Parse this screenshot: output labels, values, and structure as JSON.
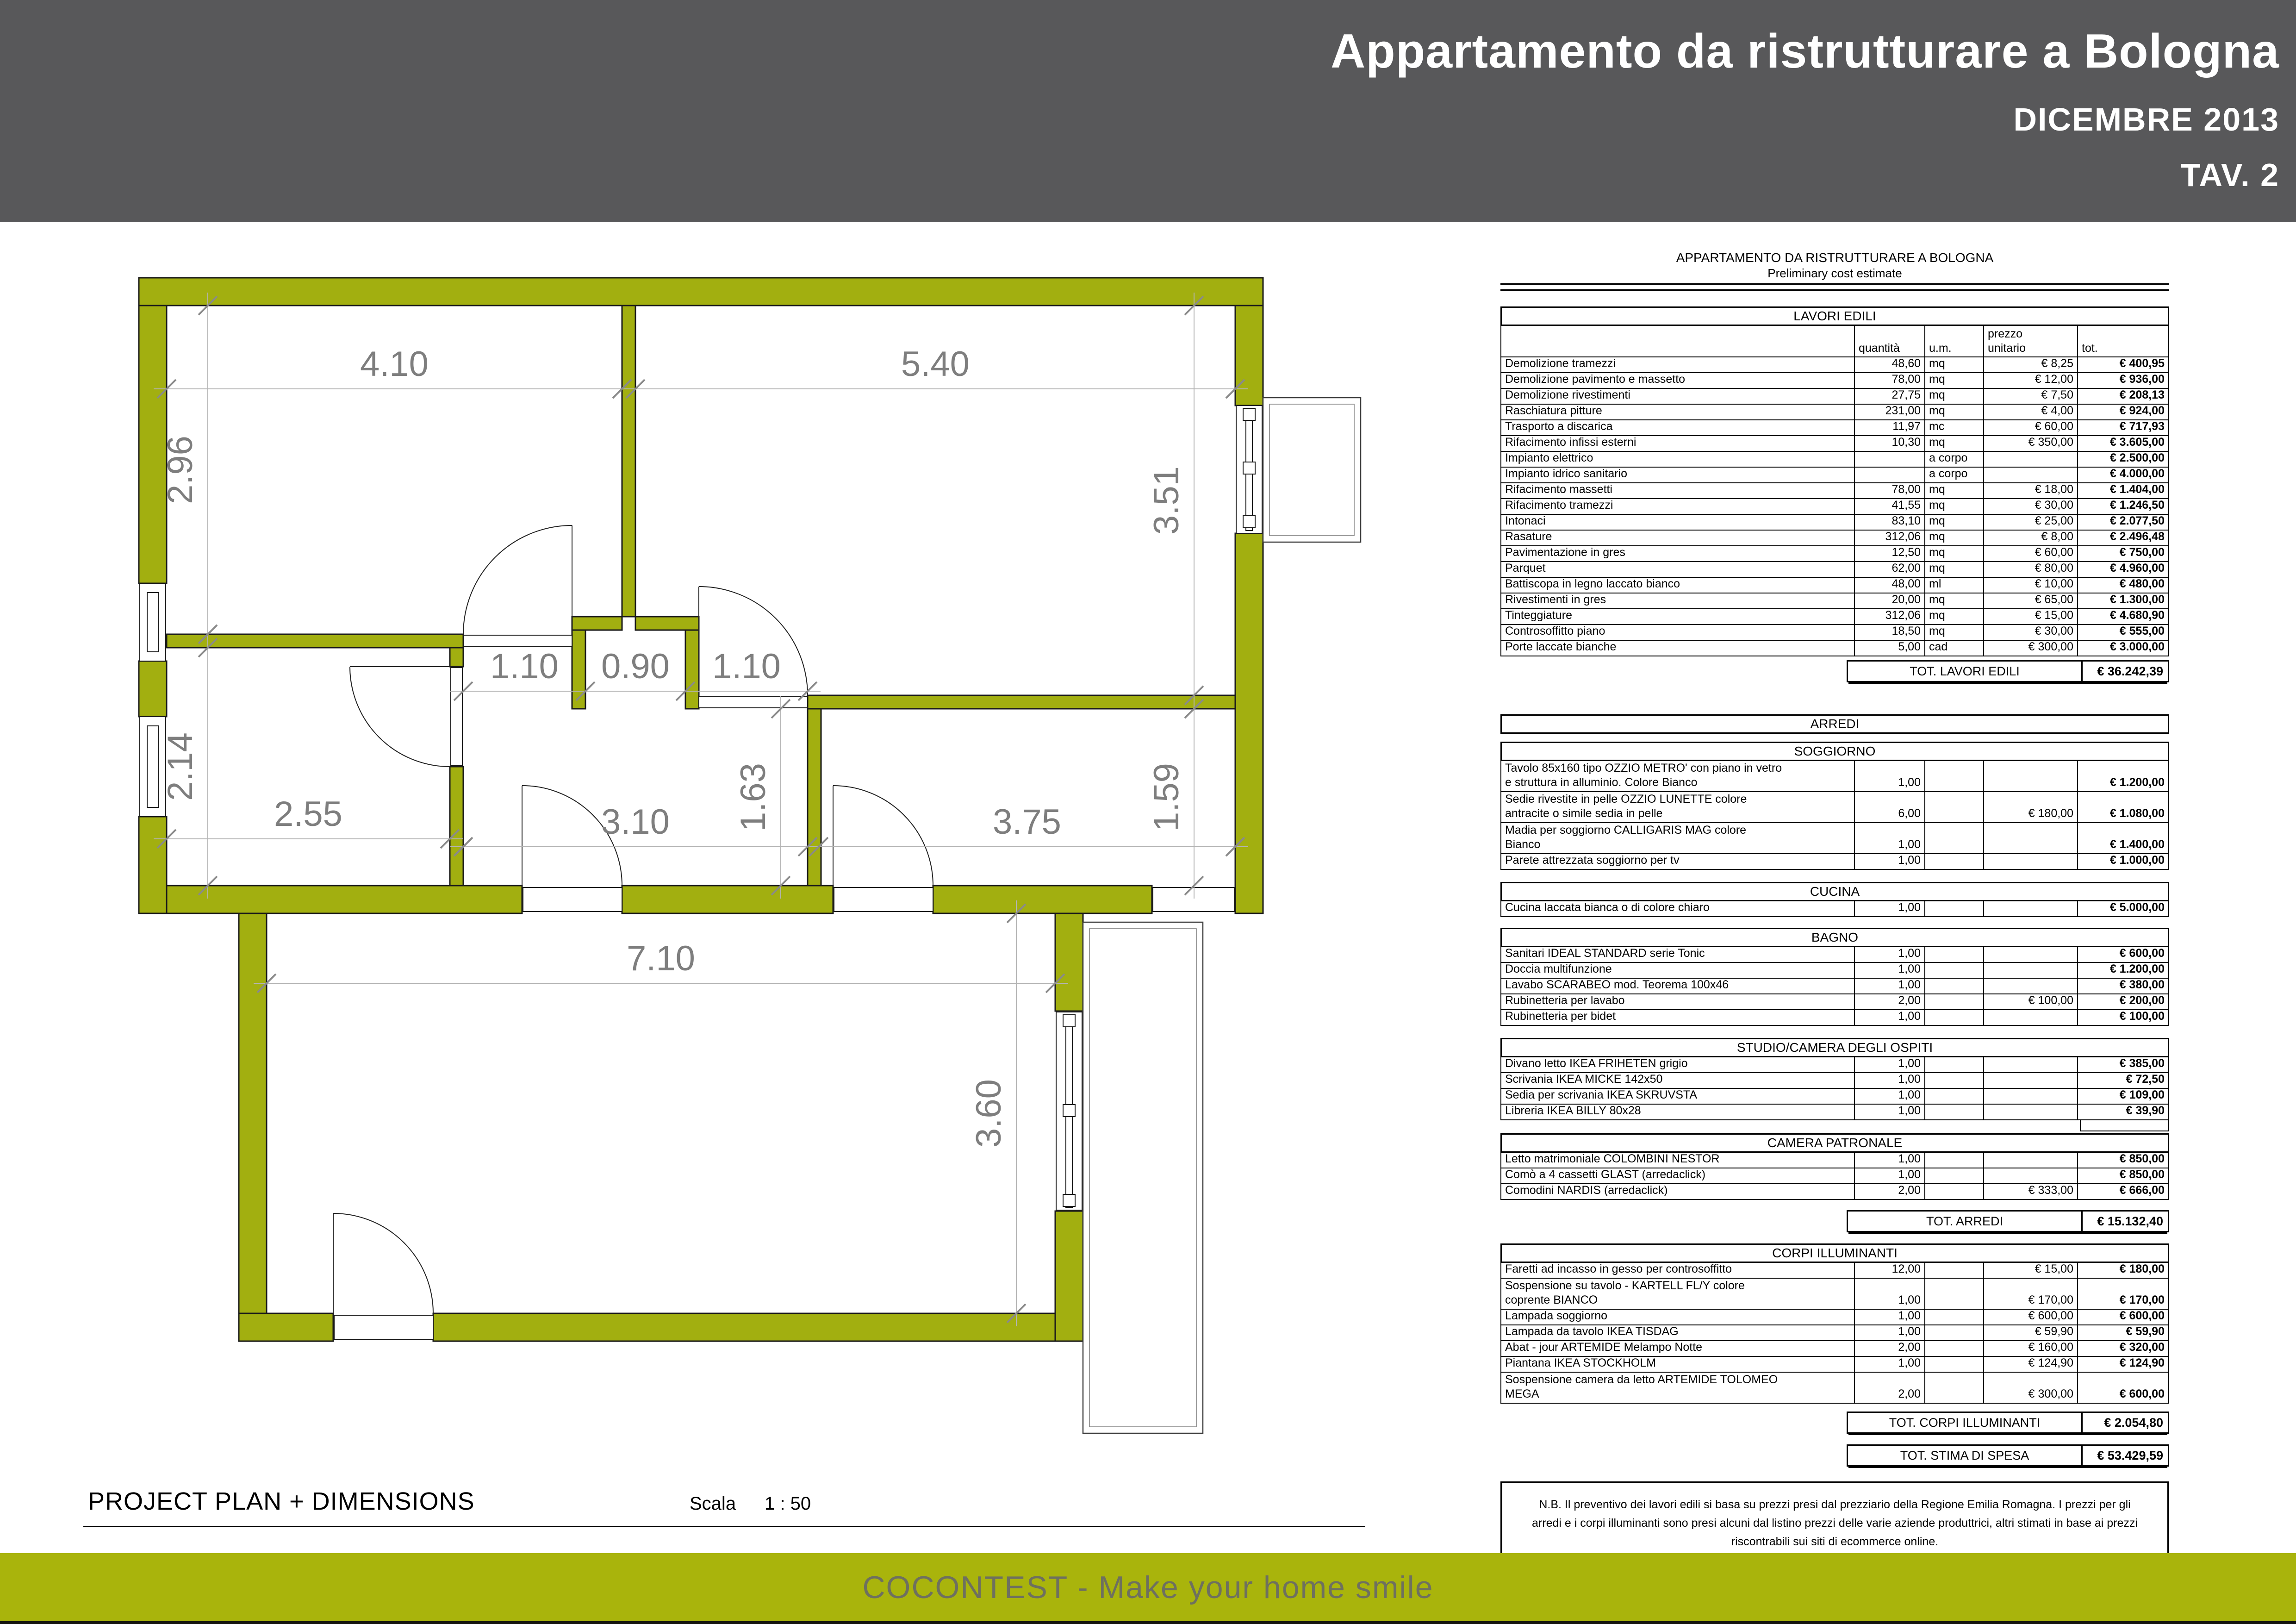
{
  "header": {
    "title": "Appartamento da ristrutturare a Bologna",
    "date": "DICEMBRE 2013",
    "sheet": "TAV. 2"
  },
  "footer": {
    "plan_label": "PROJECT PLAN + DIMENSIONS",
    "scale_label": "Scala",
    "scale_value": "1 : 50",
    "brand": "COCONTEST - Make your home smile"
  },
  "colors": {
    "wall_olive": "#a2af10",
    "band_olive": "#a9b40c",
    "header_gray": "#58585a",
    "dim_gray": "#7e7e7e",
    "tick_gray": "#8a8a8a",
    "line_gray": "#b4b4b4",
    "band_text": "#6e705f"
  },
  "plan": {
    "dims": {
      "d410": "4.10",
      "d540": "5.40",
      "d296": "2.96",
      "d351": "3.51",
      "d214": "2.14",
      "d255": "2.55",
      "d110a": "1.10",
      "d090": "0.90",
      "d110b": "1.10",
      "d163": "1.63",
      "d159": "1.59",
      "d310": "3.10",
      "d375": "3.75",
      "d710": "7.10",
      "d360": "3.60"
    }
  },
  "estimate": {
    "title": "APPARTAMENTO DA RISTRUTTURARE A BOLOGNA",
    "subtitle": "Preliminary cost estimate",
    "columns": {
      "qty": "quantità",
      "um": "u.m.",
      "price1": "prezzo",
      "price2": "unitario",
      "tot": "tot."
    },
    "lavori": {
      "header": "LAVORI EDILI",
      "rows": [
        {
          "desc": "Demolizione tramezzi",
          "qty": "48,60",
          "um": "mq",
          "price": "€ 8,25",
          "tot": "€ 400,95"
        },
        {
          "desc": "Demolizione pavimento e massetto",
          "qty": "78,00",
          "um": "mq",
          "price": "€ 12,00",
          "tot": "€ 936,00"
        },
        {
          "desc": "Demolizione rivestimenti",
          "qty": "27,75",
          "um": "mq",
          "price": "€ 7,50",
          "tot": "€ 208,13"
        },
        {
          "desc": "Raschiatura pitture",
          "qty": "231,00",
          "um": "mq",
          "price": "€ 4,00",
          "tot": "€ 924,00"
        },
        {
          "desc": "Trasporto a discarica",
          "qty": "11,97",
          "um": "mc",
          "price": "€ 60,00",
          "tot": "€ 717,93"
        },
        {
          "desc": "Rifacimento infissi esterni",
          "qty": "10,30",
          "um": "mq",
          "price": "€ 350,00",
          "tot": "€ 3.605,00"
        },
        {
          "desc": "Impianto elettrico",
          "qty": "",
          "um": "a corpo",
          "price": "",
          "tot": "€ 2.500,00"
        },
        {
          "desc": "Impianto idrico sanitario",
          "qty": "",
          "um": "a corpo",
          "price": "",
          "tot": "€ 4.000,00"
        },
        {
          "desc": "Rifacimento massetti",
          "qty": "78,00",
          "um": "mq",
          "price": "€ 18,00",
          "tot": "€ 1.404,00"
        },
        {
          "desc": "Rifacimento tramezzi",
          "qty": "41,55",
          "um": "mq",
          "price": "€ 30,00",
          "tot": "€ 1.246,50"
        },
        {
          "desc": "Intonaci",
          "qty": "83,10",
          "um": "mq",
          "price": "€ 25,00",
          "tot": "€ 2.077,50"
        },
        {
          "desc": "Rasature",
          "qty": "312,06",
          "um": "mq",
          "price": "€ 8,00",
          "tot": "€ 2.496,48"
        },
        {
          "desc": "Pavimentazione in gres",
          "qty": "12,50",
          "um": "mq",
          "price": "€ 60,00",
          "tot": "€ 750,00"
        },
        {
          "desc": "Parquet",
          "qty": "62,00",
          "um": "mq",
          "price": "€ 80,00",
          "tot": "€ 4.960,00"
        },
        {
          "desc": "Battiscopa in legno laccato bianco",
          "qty": "48,00",
          "um": "ml",
          "price": "€ 10,00",
          "tot": "€ 480,00"
        },
        {
          "desc": "Rivestimenti in gres",
          "qty": "20,00",
          "um": "mq",
          "price": "€ 65,00",
          "tot": "€ 1.300,00"
        },
        {
          "desc": "Tinteggiature",
          "qty": "312,06",
          "um": "mq",
          "price": "€ 15,00",
          "tot": "€ 4.680,90"
        },
        {
          "desc": "Controsoffitto piano",
          "qty": "18,50",
          "um": "mq",
          "price": "€ 30,00",
          "tot": "€ 555,00"
        },
        {
          "desc": "Porte laccate bianche",
          "qty": "5,00",
          "um": "cad",
          "price": "€ 300,00",
          "tot": "€ 3.000,00"
        }
      ],
      "total_label": "TOT. LAVORI EDILI",
      "total": "€ 36.242,39"
    },
    "arredi_header": "ARREDI",
    "arredi_sections": [
      {
        "header": "SOGGIORNO",
        "rows": [
          {
            "desc": "Tavolo 85x160 tipo OZZIO METRO' con piano in vetro",
            "desc2": "e struttura in alluminio. Colore Bianco",
            "qty": "1,00",
            "um": "",
            "price": "",
            "tot": "€ 1.200,00"
          },
          {
            "desc": "Sedie rivestite in pelle OZZIO LUNETTE colore",
            "desc2": "antracite o simile sedia in pelle",
            "qty": "6,00",
            "um": "",
            "price": "€ 180,00",
            "tot": "€ 1.080,00"
          },
          {
            "desc": "Madia per soggiorno CALLIGARIS MAG colore",
            "desc2": "Bianco",
            "qty": "1,00",
            "um": "",
            "price": "",
            "tot": "€ 1.400,00"
          },
          {
            "desc": "Parete attrezzata soggiorno per tv",
            "qty": "1,00",
            "um": "",
            "price": "",
            "tot": "€ 1.000,00"
          }
        ]
      },
      {
        "header": "CUCINA",
        "rows": [
          {
            "desc": "Cucina laccata bianca o di colore chiaro",
            "qty": "1,00",
            "um": "",
            "price": "",
            "tot": "€ 5.000,00"
          }
        ]
      },
      {
        "header": "BAGNO",
        "rows": [
          {
            "desc": "Sanitari IDEAL STANDARD serie Tonic",
            "qty": "1,00",
            "um": "",
            "price": "",
            "tot": "€ 600,00"
          },
          {
            "desc": "Doccia multifunzione",
            "qty": "1,00",
            "um": "",
            "price": "",
            "tot": "€ 1.200,00"
          },
          {
            "desc": "Lavabo SCARABEO mod. Teorema 100x46",
            "qty": "1,00",
            "um": "",
            "price": "",
            "tot": "€ 380,00"
          },
          {
            "desc": "Rubinetteria per lavabo",
            "qty": "2,00",
            "um": "",
            "price": "€ 100,00",
            "tot": "€ 200,00"
          },
          {
            "desc": "Rubinetteria per bidet",
            "qty": "1,00",
            "um": "",
            "price": "",
            "tot": "€ 100,00"
          }
        ]
      },
      {
        "header": "STUDIO/CAMERA DEGLI OSPITI",
        "rows": [
          {
            "desc": "Divano letto IKEA FRIHETEN grigio",
            "qty": "1,00",
            "um": "",
            "price": "",
            "tot": "€ 385,00"
          },
          {
            "desc": "Scrivania IKEA MICKE 142x50",
            "qty": "1,00",
            "um": "",
            "price": "",
            "tot": "€ 72,50"
          },
          {
            "desc": "Sedia per scrivania IKEA SKRUVSTA",
            "qty": "1,00",
            "um": "",
            "price": "",
            "tot": "€ 109,00"
          },
          {
            "desc": "Libreria IKEA BILLY 80x28",
            "qty": "1,00",
            "um": "",
            "price": "",
            "tot": "€ 39,90"
          }
        ],
        "trailing_empty": true
      },
      {
        "header": "CAMERA PATRONALE",
        "rows": [
          {
            "desc": "Letto matrimoniale COLOMBINI NESTOR",
            "qty": "1,00",
            "um": "",
            "price": "",
            "tot": "€ 850,00"
          },
          {
            "desc": "Comò a 4 cassetti GLAST (arredaclick)",
            "qty": "1,00",
            "um": "",
            "price": "",
            "tot": "€ 850,00"
          },
          {
            "desc": "Comodini NARDIS (arredaclick)",
            "qty": "2,00",
            "um": "",
            "price": "€ 333,00",
            "tot": "€ 666,00"
          }
        ]
      }
    ],
    "arredi_total_label": "TOT. ARREDI",
    "arredi_total": "€ 15.132,40",
    "corpi": {
      "header": "CORPI ILLUMINANTI",
      "rows": [
        {
          "desc": "Faretti ad incasso in gesso per controsoffitto",
          "qty": "12,00",
          "um": "",
          "price": "€ 15,00",
          "tot": "€ 180,00"
        },
        {
          "desc": "Sospensione su tavolo - KARTELL FL/Y colore",
          "desc2": "coprente BIANCO",
          "qty": "1,00",
          "um": "",
          "price": "€ 170,00",
          "tot": "€ 170,00"
        },
        {
          "desc": "Lampada soggiorno",
          "qty": "1,00",
          "um": "",
          "price": "€ 600,00",
          "tot": "€ 600,00"
        },
        {
          "desc": "Lampada da tavolo IKEA TISDAG",
          "qty": "1,00",
          "um": "",
          "price": "€ 59,90",
          "tot": "€ 59,90"
        },
        {
          "desc": "Abat - jour ARTEMIDE Melampo Notte",
          "qty": "2,00",
          "um": "",
          "price": "€ 160,00",
          "tot": "€ 320,00"
        },
        {
          "desc": "Piantana IKEA STOCKHOLM",
          "qty": "1,00",
          "um": "",
          "price": "€ 124,90",
          "tot": "€ 124,90"
        },
        {
          "desc": "Sospensione camera da letto ARTEMIDE TOLOMEO",
          "desc2": "MEGA",
          "qty": "2,00",
          "um": "",
          "price": "€ 300,00",
          "tot": "€ 600,00"
        }
      ]
    },
    "corpi_total_label": "TOT. CORPI ILLUMINANTI",
    "corpi_total": "€ 2.054,80",
    "grand_total_label": "TOT. STIMA DI SPESA",
    "grand_total": "€ 53.429,59",
    "note": "N.B. Il preventivo dei lavori edili si basa su prezzi presi dal prezziario della Regione Emilia Romagna. I prezzi per gli arredi e i corpi illuminanti sono presi alcuni dal listino prezzi delle varie aziende produttrici, altri stimati in base ai prezzi riscontrabili sui siti di ecommerce online."
  }
}
